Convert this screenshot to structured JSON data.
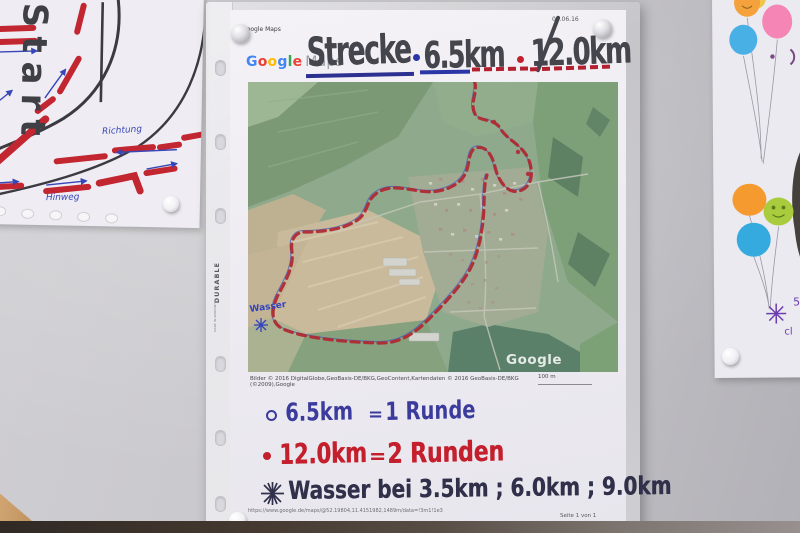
{
  "left_poster": {
    "start": "Start",
    "richtung": "Richtung",
    "hinweg": "Hinweg"
  },
  "page": {
    "header_app": "Google Maps",
    "header_date": "06.06.16",
    "logo_google": "Google",
    "logo_maps": "Maps",
    "title_name": "Strecke",
    "title_dist1": "6.5km",
    "title_dist2": "12.0km",
    "map_watermark": "Google",
    "map_wasser": "Wasser",
    "attribution": "Bilder © 2016 DigitalGlobe,GeoBasis-DE/BKG,GeoContent,Kartendaten © 2016 GeoBasis-DE/BKG (©2009),Google",
    "scale": "100 m",
    "note1_km": "6.5km",
    "note1_eq": "=",
    "note1_desc": "1 Runde",
    "note2_km": "12.0km",
    "note2_eq": "=",
    "note2_desc": "2 Runden",
    "note3": "Wasser bei 3.5km ; 6.0km ; 9.0km",
    "footer_url": "https://www.google.de/maps/@52.19804,11.4151982,1489m/data=!3m1!1e3",
    "footer_page": "Seite 1 von 1"
  },
  "sleeve": {
    "brand": "DURABLE",
    "made": "MADE IN GERMANY"
  },
  "right_poster": {
    "partial_a": "5",
    "partial_b": "cl"
  },
  "colors": {
    "route_red": "#b02028",
    "note_blue": "#3b3b9e",
    "note_red": "#c31f2c",
    "title_gray": "#45454d",
    "underline_blue": "#2a35a8"
  }
}
